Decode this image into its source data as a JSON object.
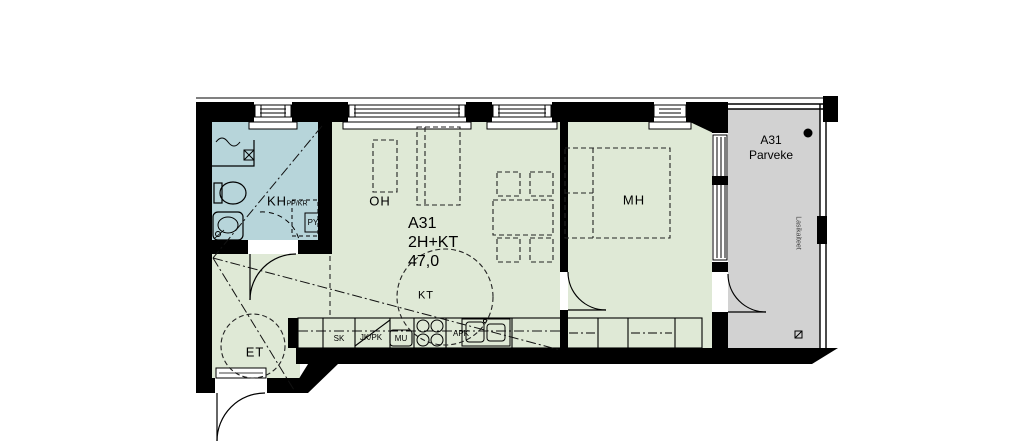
{
  "plan": {
    "apartment": {
      "id": "A31",
      "type": "2H+KT",
      "area": "47,0"
    },
    "rooms": {
      "bathroom": {
        "label": "KH"
      },
      "hall": {
        "label": "ET"
      },
      "living": {
        "label": "OH"
      },
      "kitchen": {
        "label": "KT"
      },
      "bedroom": {
        "label": "MH"
      }
    },
    "bathroom_labels": {
      "washer_dryer": "PP/KR",
      "laundry": "PY"
    },
    "kitchen_labels": {
      "sk": "SK",
      "jkpk": "JK/PK",
      "mu": "MU",
      "apk": "APK"
    },
    "balcony": {
      "id": "A31",
      "label": "Parveke",
      "railing_note": "Lasikaiteet"
    },
    "colors": {
      "room_fill": "#dfe9d6",
      "bathroom_fill": "#b7d5da",
      "balcony_fill": "#d2d2d2",
      "wall": "#000000",
      "background": "#ffffff"
    }
  }
}
